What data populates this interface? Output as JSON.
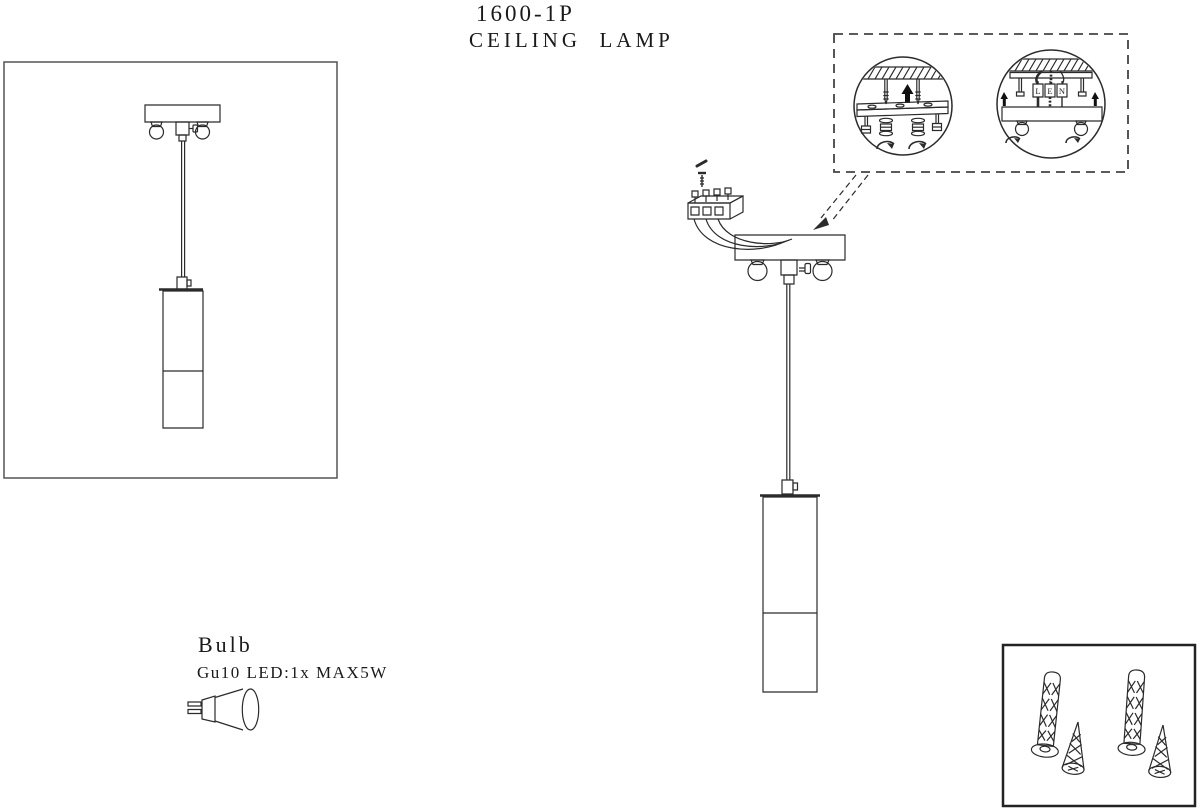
{
  "title": {
    "model": "1600-1P",
    "product": "CEILING  LAMP"
  },
  "bulb": {
    "heading": "Bulb",
    "spec": "Gu10 LED:1x MAX5W",
    "icon": "gu10-bulb-icon"
  },
  "callout": {
    "terminals": [
      "L",
      "E",
      "N"
    ],
    "icons": [
      "up-arrow-icon",
      "rotate-clockwise-arrow-icon",
      "hatched-ceiling",
      "mounting-screw-icon"
    ]
  },
  "hardware": {
    "icons": [
      "wall-plug-icon",
      "wall-plug-icon",
      "tapping-screw-icon",
      "tapping-screw-icon"
    ]
  },
  "colors": {
    "line": "#2b2b2b",
    "box_border": "#444444",
    "text": "#1a1a1a"
  }
}
